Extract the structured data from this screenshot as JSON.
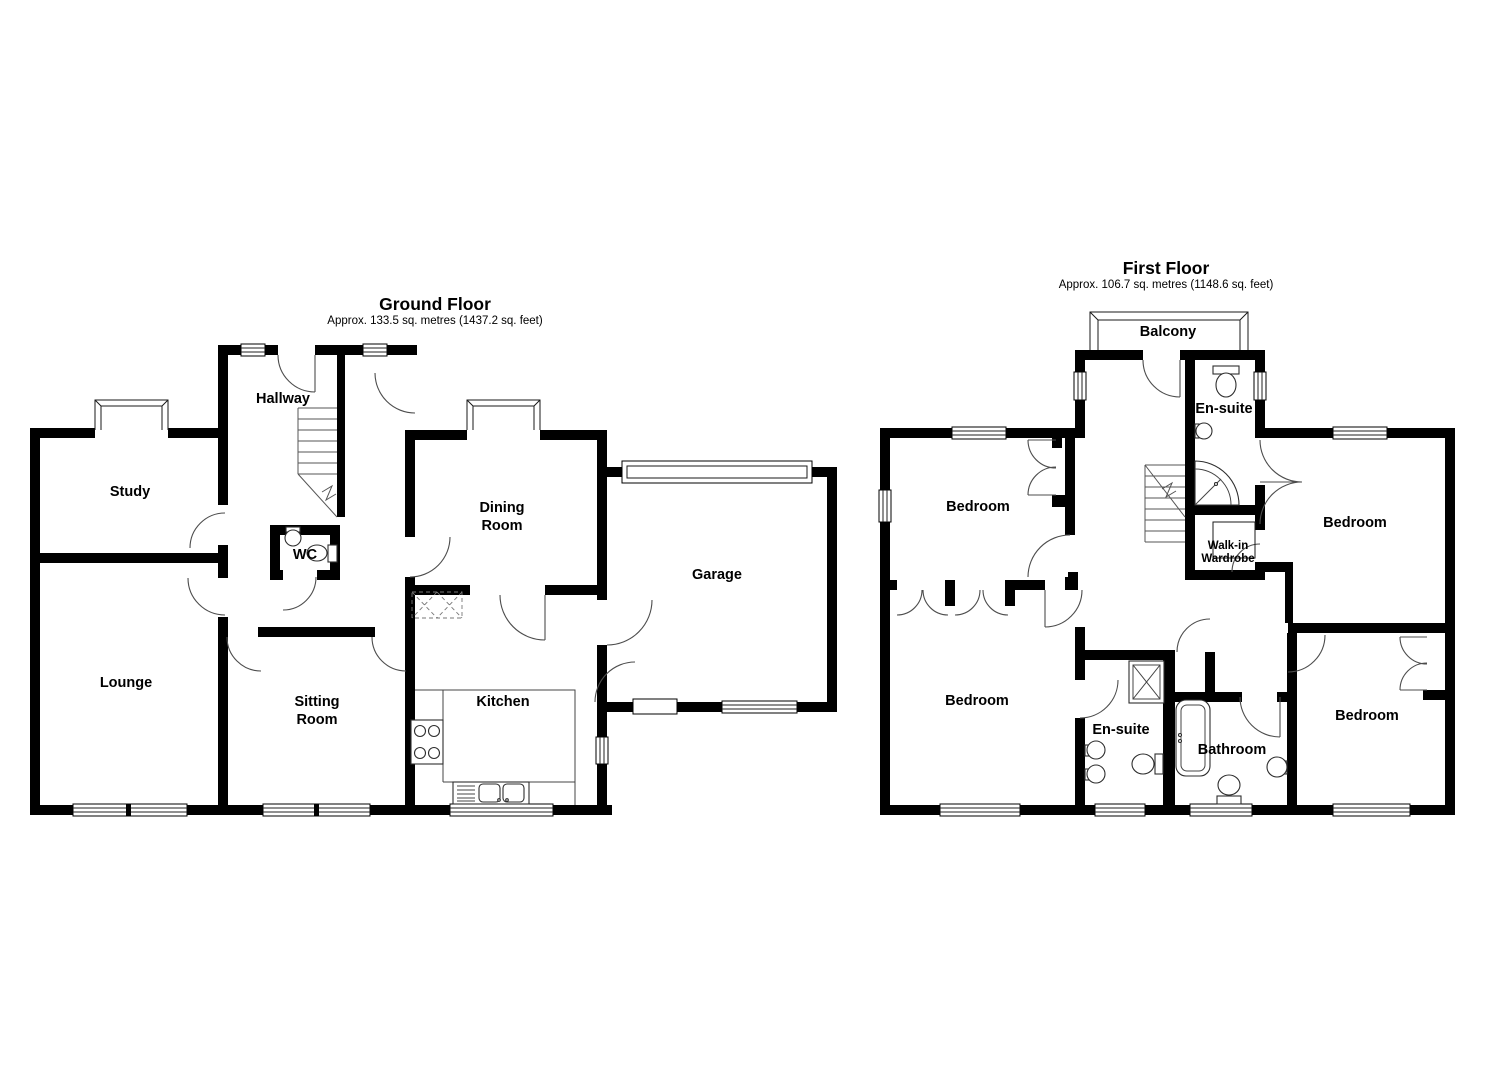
{
  "colors": {
    "wall": "#000000",
    "background": "#ffffff",
    "line": "#4d4d4d"
  },
  "ground_floor": {
    "title": "Ground Floor",
    "area": "Approx. 133.5 sq. metres (1437.2 sq. feet)",
    "labels": {
      "hallway": "Hallway",
      "study": "Study",
      "wc": "WC",
      "dining": [
        "Dining",
        "Room"
      ],
      "lounge": "Lounge",
      "sitting": [
        "Sitting",
        "Room"
      ],
      "kitchen": "Kitchen",
      "garage": "Garage"
    }
  },
  "first_floor": {
    "title": "First Floor",
    "area": "Approx. 106.7 sq. metres (1148.6 sq. feet)",
    "labels": {
      "balcony": "Balcony",
      "ensuite_top": "En-suite",
      "bedroom_top_left": "Bedroom",
      "bedroom_top_right": "Bedroom",
      "walk_in_wardrobe": [
        "Walk-in",
        "Wardrobe"
      ],
      "bedroom_bottom_left": "Bedroom",
      "ensuite_bottom": "En-suite",
      "bathroom": "Bathroom",
      "bedroom_bottom_right": "Bedroom"
    }
  }
}
